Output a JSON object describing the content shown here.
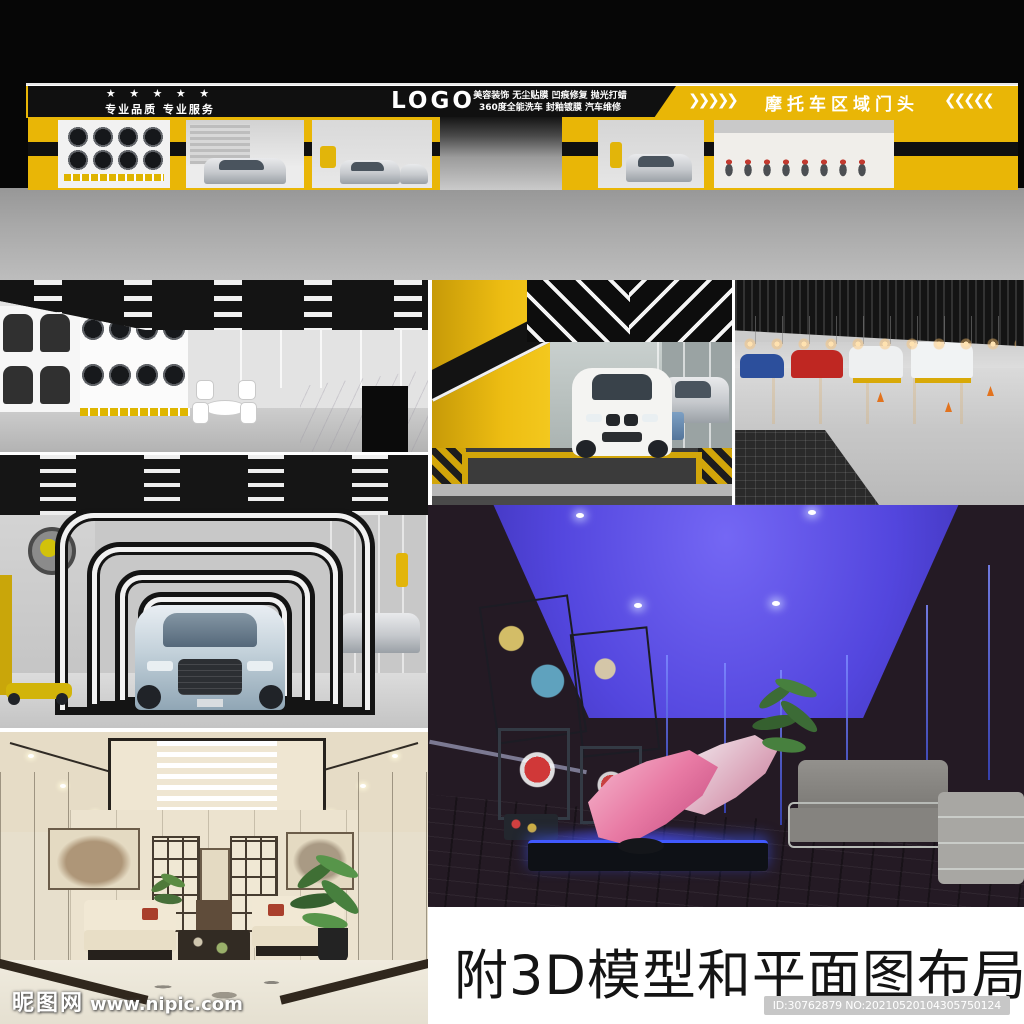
{
  "storefront": {
    "stars": "★ ★ ★ ★ ★",
    "tagline": "专业品质 专业服务",
    "logo_text": "LOGO",
    "services_line1": "美容装饰 无尘贴膜 凹痕修复 抛光打蜡",
    "services_line2": "360度全能洗车 封釉镀膜 汽车维修",
    "moto_banner": {
      "chevrons_left": "❯❯❯❯❯",
      "title": "摩托车区域门头",
      "chevrons_right": "❮❮❮❮❮"
    }
  },
  "caption": {
    "text": "附3D模型和平面图布局"
  },
  "id_badge": {
    "text": "ID:30762879 NO:20210520104305750124"
  },
  "watermark": {
    "site_name": "昵图网",
    "site_url": "www.nipic.com"
  },
  "colors": {
    "brand_yellow": "#e9b606",
    "banner_black": "#101010",
    "floor_gray": "#a8a8a8",
    "vr_ceiling_blue": "#5346de",
    "caption_black": "#141414",
    "badge_gray": "#c7c7c7"
  }
}
